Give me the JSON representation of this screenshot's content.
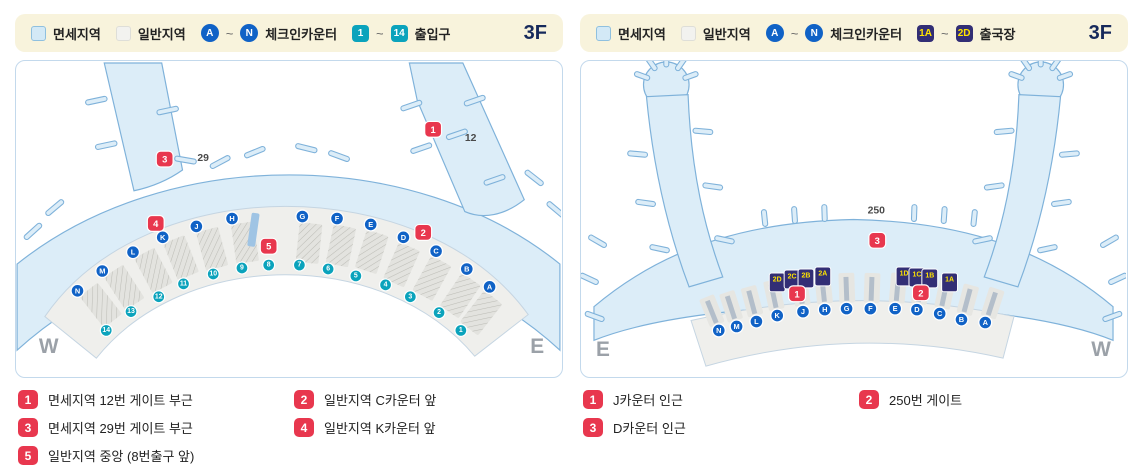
{
  "left_panel": {
    "legend": {
      "dutyfree": "면세지역",
      "general": "일반지역",
      "counter_from": "A",
      "tilde": "~",
      "counter_to": "N",
      "counter_label": "체크인카운터",
      "gate_from": "1",
      "gate_to": "14",
      "gate_label": "출입구",
      "floor": "3F"
    },
    "map": {
      "west": "W",
      "east": "E",
      "gate29": "29",
      "gate12": "12",
      "counters": [
        "N",
        "M",
        "L",
        "K",
        "J",
        "H",
        "G",
        "F",
        "E",
        "D",
        "C",
        "B",
        "A"
      ],
      "exits": [
        "14",
        "13",
        "12",
        "11",
        "10",
        "9",
        "8",
        "7",
        "6",
        "5",
        "4",
        "3",
        "2",
        "1"
      ],
      "badges": [
        "1",
        "2",
        "3",
        "4",
        "5"
      ]
    },
    "list": [
      {
        "num": "1",
        "text": "면세지역 12번 게이트 부근"
      },
      {
        "num": "2",
        "text": "일반지역 C카운터 앞"
      },
      {
        "num": "3",
        "text": "면세지역 29번 게이트 부근"
      },
      {
        "num": "4",
        "text": "일반지역 K카운터 앞"
      },
      {
        "num": "5",
        "text": "일반지역 중앙 (8번출구 앞)"
      }
    ]
  },
  "right_panel": {
    "legend": {
      "dutyfree": "면세지역",
      "general": "일반지역",
      "counter_from": "A",
      "tilde": "~",
      "counter_to": "N",
      "counter_label": "체크인카운터",
      "gate_from": "1A",
      "gate_to": "2D",
      "gate_label": "출국장",
      "floor": "3F"
    },
    "map": {
      "west": "W",
      "east": "E",
      "gate250": "250",
      "counters": [
        "N",
        "M",
        "L",
        "K",
        "J",
        "H",
        "G",
        "F",
        "E",
        "D",
        "C",
        "B",
        "A"
      ],
      "departures": [
        "2D",
        "2C",
        "2B",
        "2A",
        "1D",
        "1C",
        "1B",
        "1A"
      ],
      "badges": [
        "1",
        "2",
        "3"
      ]
    },
    "list": [
      {
        "num": "1",
        "text": "J카운터 인근"
      },
      {
        "num": "2",
        "text": "250번 게이트"
      },
      {
        "num": "3",
        "text": "D카운터 인근"
      }
    ]
  }
}
